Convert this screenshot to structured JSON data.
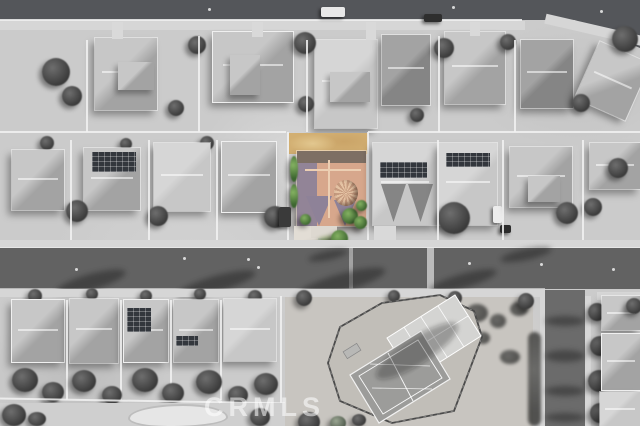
{
  "image": {
    "kind": "aerial-photograph",
    "subject": "suburban neighborhood, black-and-white except one highlighted home with tan tile roof",
    "dimensions": "640x426"
  },
  "watermark": {
    "text": "CRMLS"
  },
  "palette": {
    "ground": "#cbcbcb",
    "street": "#626262",
    "street-top": "#54565a",
    "sidewalk": "#d6d6d6",
    "roof-light": "#c7c7c7",
    "roof-mid": "#a3a3a3",
    "roof-dark": "#858585",
    "gable-white": "#f0f0f0",
    "solar": "#33373d",
    "tree": "#3a3a3a",
    "roof-tan": "#d7a78c",
    "roof-tan-shade": "#8e8298",
    "roof-tan-dark": "#7d6f64",
    "roof-ridge": "#eccfb3",
    "dirt-tan": "#d2af72",
    "dirt-tan-light": "#e2c78f",
    "green-dark": "#3c662f",
    "green-light": "#84b162",
    "lawn": "#86a060",
    "bin-blue": "#3f6fd0",
    "court-light": "#d4d4d2",
    "court-dark": "#9c9c9a",
    "fence": "#4a4a4a"
  },
  "scene": {
    "highlighted_lot": {
      "name": "subject-property",
      "in_color": true
    },
    "streets": [
      {
        "name": "top-street"
      },
      {
        "name": "main-street"
      },
      {
        "name": "side-street"
      }
    ],
    "landmarks": [
      {
        "name": "sports-court-complex"
      },
      {
        "name": "vacant-dirt-lot"
      },
      {
        "name": "backyard-pool"
      }
    ]
  }
}
